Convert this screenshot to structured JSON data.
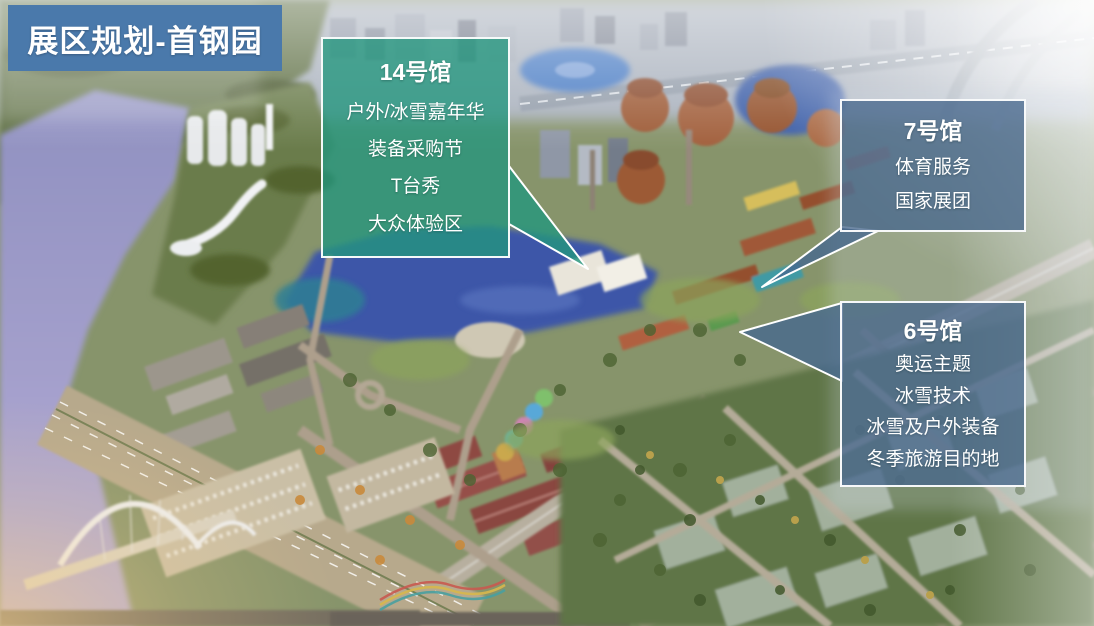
{
  "header": {
    "title": "展区规划-首钢园",
    "background_color": "#4a79ab",
    "text_color": "#ffffff"
  },
  "callouts": [
    {
      "id": "hall-14",
      "title": "14号馆",
      "items": [
        "户外/冰雪嘉年华",
        "装备采购节",
        "T台秀",
        "大众体验区"
      ],
      "style": "teal",
      "fill_color": "#23967d"
    },
    {
      "id": "hall-7",
      "title": "7号馆",
      "items": [
        "体育服务",
        "国家展团"
      ],
      "style": "blue",
      "fill_color": "#46688e"
    },
    {
      "id": "hall-6",
      "title": "6号馆",
      "items": [
        "奥运主题",
        "冰雪技术",
        "冰雪及户外装备",
        "冬季旅游目的地"
      ],
      "style": "blue",
      "fill_color": "#46688e"
    }
  ],
  "scene": {
    "description": "aerial-rendering-of-shougang-park-exhibition-area",
    "palette": {
      "river": "#9a99c9",
      "lake": "#3c57a8",
      "parkland": "#6d7d4e",
      "furnace_rust": "#a05d3a",
      "roads": "#b4ab98",
      "haze": "#ffffff",
      "warm_glow": "#f7cf8a"
    }
  }
}
